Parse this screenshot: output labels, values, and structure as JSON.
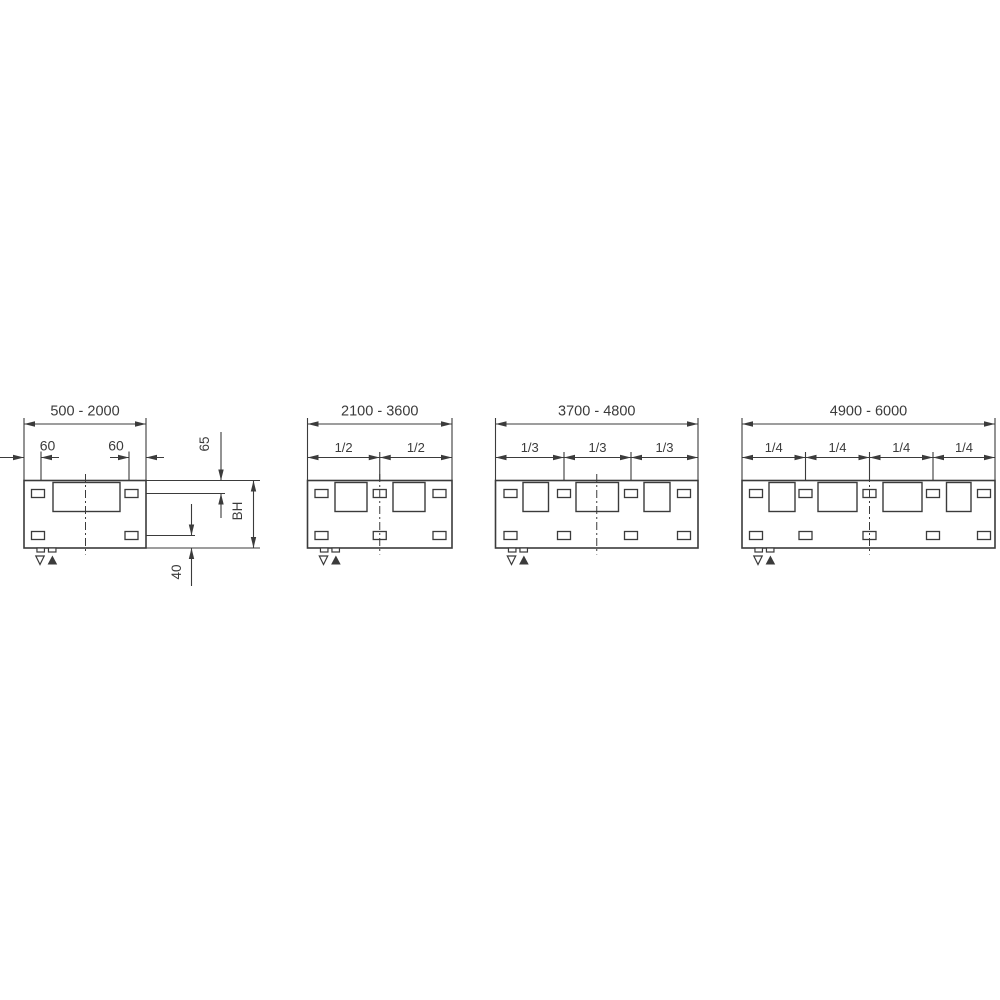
{
  "drawing": {
    "background": "#ffffff",
    "line_color": "#3b3b3b",
    "markers": [
      {
        "name": "level-marker-open-down-icon",
        "glyph": "▽"
      },
      {
        "name": "level-marker-filled-up-icon",
        "glyph": "▲"
      }
    ],
    "metrics": {
      "panel_y": 480.5,
      "panel_h": 67.5,
      "window_y": 482.5,
      "window_h": 29,
      "slot_w": 13,
      "slot_h": 8,
      "top_slot_cy": 493.5,
      "bottom_slot_cy": 535.5,
      "main_dim_y": 424,
      "main_label_y": 415.5,
      "chain_dim_y": 457.5,
      "chain_label_y": 452,
      "ext_top_y": 418,
      "chain_ext_top_y": 452,
      "slot_ext_bottom_y": 489.5,
      "centerline_top": 474,
      "centerline_bottom": 554.5,
      "foot_w": 7.5,
      "foot_h": 4,
      "foot_offsets": [
        16.7,
        28.2
      ],
      "marker_open_offset": 16,
      "marker_filled_offset": 28.4,
      "marker_top_y": 556,
      "marker_bottom_y": 564.5
    },
    "diagrams": [
      {
        "id": "range-500-2000",
        "range_label": "500 - 2000",
        "panel": {
          "x": 24,
          "w": 122
        },
        "windows": [
          {
            "x": 53,
            "w": 67
          }
        ],
        "slot_centers": [
          38,
          131.5
        ],
        "centerline_x": 85.5,
        "slot_ext_x": [
          41,
          129
        ],
        "edge_dims": [
          {
            "label": "60",
            "tip_a": 24,
            "tail_a": 0,
            "tip_b": 41,
            "tail_b": 59,
            "label_cx": 47.5
          },
          {
            "label": "60",
            "tip_a": 129,
            "tail_a": 110,
            "tip_b": 146,
            "tail_b": 164,
            "label_cx": 116
          }
        ],
        "right_ext_lines": [
          {
            "y": 480.5,
            "x1": 146.5,
            "x2": 260
          },
          {
            "y": 493.5,
            "x1": 139,
            "x2": 225
          },
          {
            "y": 535.5,
            "x1": 139,
            "x2": 195
          },
          {
            "y": 548,
            "x1": 146.5,
            "x2": 260
          }
        ],
        "side_dims": [
          {
            "label": "65",
            "x": 221,
            "a": 480.5,
            "b": 493.5,
            "tail_a": 432,
            "tail_b": 518,
            "style": "outside",
            "label_cx": 209,
            "label_cy": 444
          },
          {
            "label": "BH",
            "x": 253.5,
            "a": 480.5,
            "b": 548,
            "style": "inside",
            "label_cx": 242,
            "label_cy": 511
          },
          {
            "label": "40",
            "x": 191.5,
            "a": 535.5,
            "b": 548,
            "tail_a": 504,
            "tail_b": 586,
            "style": "outside",
            "label_cx": 181,
            "label_cy": 572
          }
        ]
      },
      {
        "id": "range-2100-3600",
        "range_label": "2100 - 3600",
        "panel": {
          "x": 307.5,
          "w": 144.5
        },
        "windows": [
          {
            "x": 335,
            "w": 32
          },
          {
            "x": 393,
            "w": 32
          }
        ],
        "slot_centers": [
          321.5,
          379.75,
          439.5
        ],
        "centerline_x": 379.75,
        "chain": {
          "points": [
            307.5,
            379.75,
            452
          ],
          "labels": [
            "1/2",
            "1/2"
          ]
        }
      },
      {
        "id": "range-3700-4800",
        "range_label": "3700 - 4800",
        "panel": {
          "x": 495.5,
          "w": 202.5
        },
        "windows": [
          {
            "x": 523,
            "w": 25.5
          },
          {
            "x": 576,
            "w": 42.5
          },
          {
            "x": 644,
            "w": 26
          }
        ],
        "slot_centers": [
          510.5,
          564,
          631,
          684
        ],
        "centerline_x": 596.75,
        "chain": {
          "points": [
            495.5,
            564,
            631,
            698
          ],
          "labels": [
            "1/3",
            "1/3",
            "1/3"
          ]
        }
      },
      {
        "id": "range-4900-6000",
        "range_label": "4900 - 6000",
        "panel": {
          "x": 742,
          "w": 253
        },
        "windows": [
          {
            "x": 769,
            "w": 26
          },
          {
            "x": 818,
            "w": 39
          },
          {
            "x": 883,
            "w": 39
          },
          {
            "x": 946.5,
            "w": 24.5
          }
        ],
        "slot_centers": [
          756,
          805.5,
          869.5,
          933,
          984
        ],
        "centerline_x": 869.5,
        "chain": {
          "points": [
            742,
            805.5,
            869.5,
            933,
            995
          ],
          "labels": [
            "1/4",
            "1/4",
            "1/4",
            "1/4"
          ]
        }
      }
    ]
  }
}
